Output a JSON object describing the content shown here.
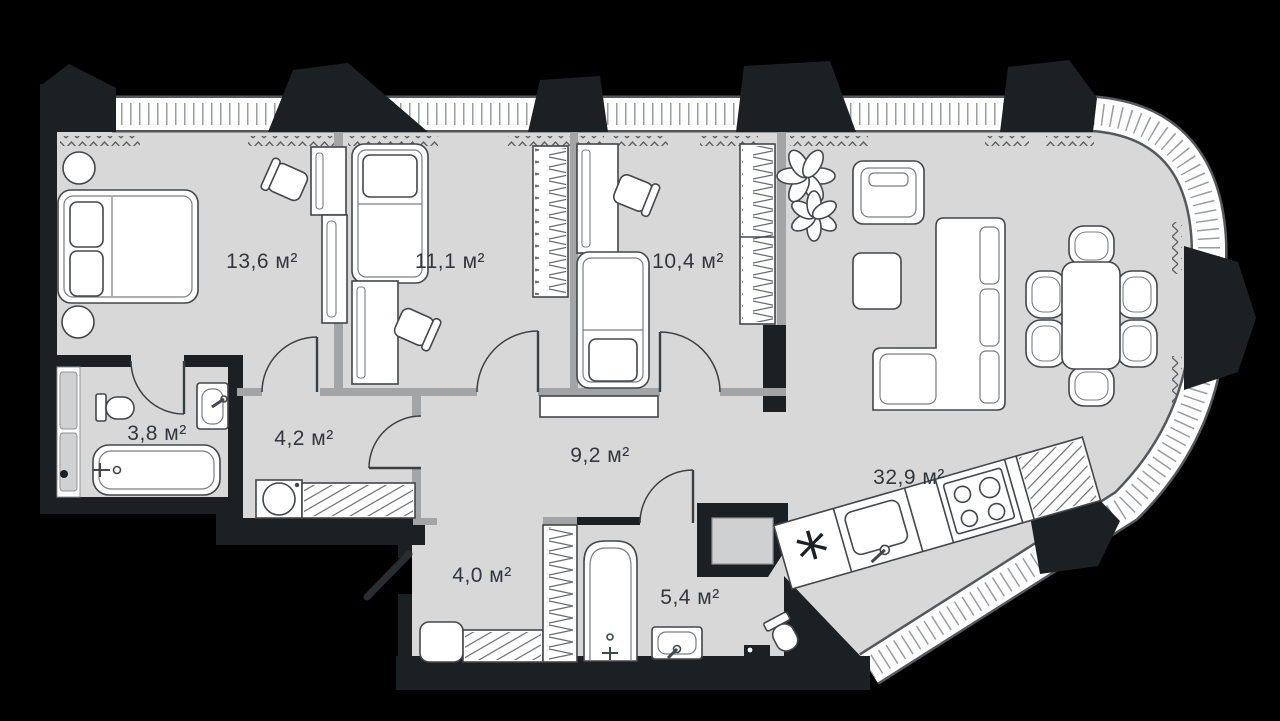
{
  "plan": {
    "type": "apartment-floor-plan",
    "area_unit": "м²",
    "rooms": [
      {
        "id": "bedroom-1",
        "area_label": "13,6 м²"
      },
      {
        "id": "bedroom-2",
        "area_label": "11,1 м²"
      },
      {
        "id": "bedroom-3",
        "area_label": "10,4 м²"
      },
      {
        "id": "bathroom-1",
        "area_label": "3,8 м²"
      },
      {
        "id": "hallway-1",
        "area_label": "4,2 м²"
      },
      {
        "id": "corridor",
        "area_label": "9,2 м²"
      },
      {
        "id": "living-kitchen",
        "area_label": "32,9 м²"
      },
      {
        "id": "hallway-2",
        "area_label": "4,0 м²"
      },
      {
        "id": "bathroom-2",
        "area_label": "5,4 м²"
      }
    ],
    "kitchen": {
      "vent_symbol": "*"
    },
    "colors": {
      "background": "#000000",
      "floor": "#d8d8d8",
      "walls": "#1d2023",
      "partitions": "#a2a4a6",
      "furniture_outline": "#43474a",
      "label_text": "#33363a",
      "glazing_band": "#ffffff"
    }
  }
}
